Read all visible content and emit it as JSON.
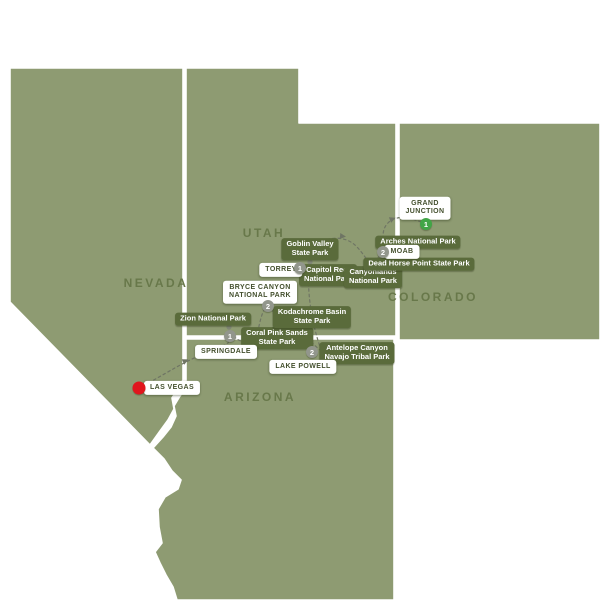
{
  "map_title": "Southwest national parks tour itinerary map",
  "colors": {
    "background": "#ffffff",
    "land": "#8e9b72",
    "state_border": "#ffffff",
    "state_label": "#68784a",
    "sight_pill_bg": "#5a6b3b",
    "sight_pill_text": "#ffffff",
    "city_pill_bg": "#ffffff",
    "city_pill_text": "#44502e",
    "route": "#6f7564",
    "waypoint_dot": "#7f8574",
    "night_marker_gray": "#92968c",
    "night_marker_green": "#41a546",
    "start_marker_red": "#e0161d"
  },
  "states": {
    "nevada": "NEVADA",
    "utah": "UTAH",
    "colorado": "COLORADO",
    "arizona": "ARIZONA"
  },
  "stops": {
    "las_vegas": {
      "label": "LAS VEGAS"
    },
    "springdale": {
      "label": "SPRINGDALE",
      "nights": "1"
    },
    "bryce_canyon": {
      "label": "BRYCE CANYON\nNATIONAL PARK",
      "nights": "2"
    },
    "lake_powell": {
      "label": "LAKE POWELL",
      "nights": "2"
    },
    "torrey": {
      "label": "TORREY",
      "nights": "1"
    },
    "moab": {
      "label": "MOAB",
      "nights": "2"
    },
    "grand_junction": {
      "label": "GRAND\nJUNCTION",
      "nights": "1"
    }
  },
  "sights": {
    "zion": "Zion National Park",
    "coral_pink": "Coral Pink Sands\nState Park",
    "kodachrome": "Kodachrome Basin\nState Park",
    "antelope": "Antelope Canyon\nNavajo Tribal Park",
    "capitol_reef": "Capitol Reef\nNational Park",
    "goblin_valley": "Goblin Valley\nState Park",
    "canyonlands": "Canyonlands\nNational Park",
    "dead_horse": "Dead Horse Point State Park",
    "arches": "Arches National Park"
  }
}
